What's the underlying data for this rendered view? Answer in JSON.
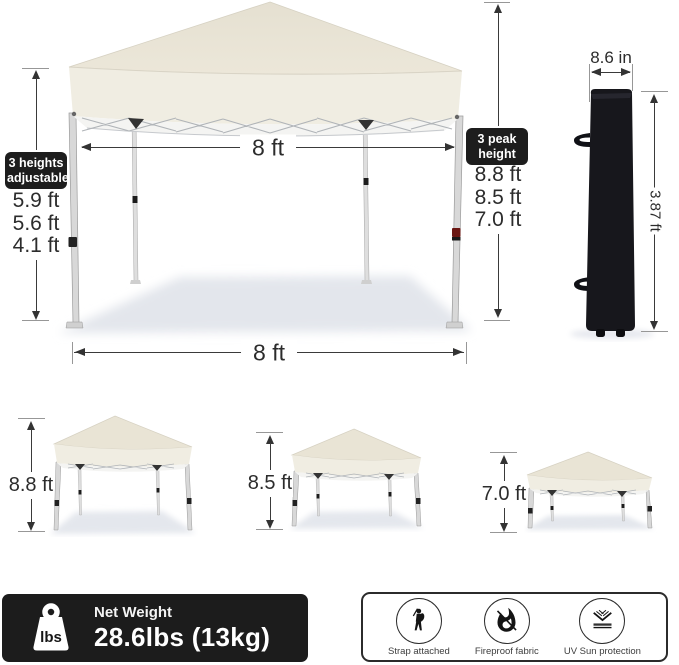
{
  "main_tent": {
    "top_width": "8 ft",
    "bottom_width": "8 ft",
    "heights_label": {
      "line1": "3 heights",
      "line2": "adjustable"
    },
    "leg_heights": [
      "5.9 ft",
      "5.6 ft",
      "4.1 ft"
    ],
    "peak_label": {
      "line1": "3 peak",
      "line2": "height"
    },
    "peak_heights": [
      "8.8 ft",
      "8.5 ft",
      "7.0 ft"
    ]
  },
  "carry_bag": {
    "width_label": "8.6 in",
    "height_label": "3.87 ft"
  },
  "height_variants": [
    {
      "label": "8.8 ft"
    },
    {
      "label": "8.5 ft"
    },
    {
      "label": "7.0 ft"
    }
  ],
  "weight_banner": {
    "icon_text": "lbs",
    "title": "Net Weight",
    "value": "28.6lbs (13kg)"
  },
  "features": [
    {
      "label": "Strap attached",
      "icon": "person-carrying-bag-icon"
    },
    {
      "label": "Fireproof fabric",
      "icon": "no-fire-icon"
    },
    {
      "label": "UV Sun protection",
      "icon": "uv-protection-icon"
    }
  ],
  "colors": {
    "canopy": "#e9e4d6",
    "canopy_band": "#f0ede2",
    "label_bg": "#1d1d1d",
    "banner_bg": "#1c1c1c",
    "bag": "#17171c",
    "dimension_line": "#3a3a3a"
  }
}
